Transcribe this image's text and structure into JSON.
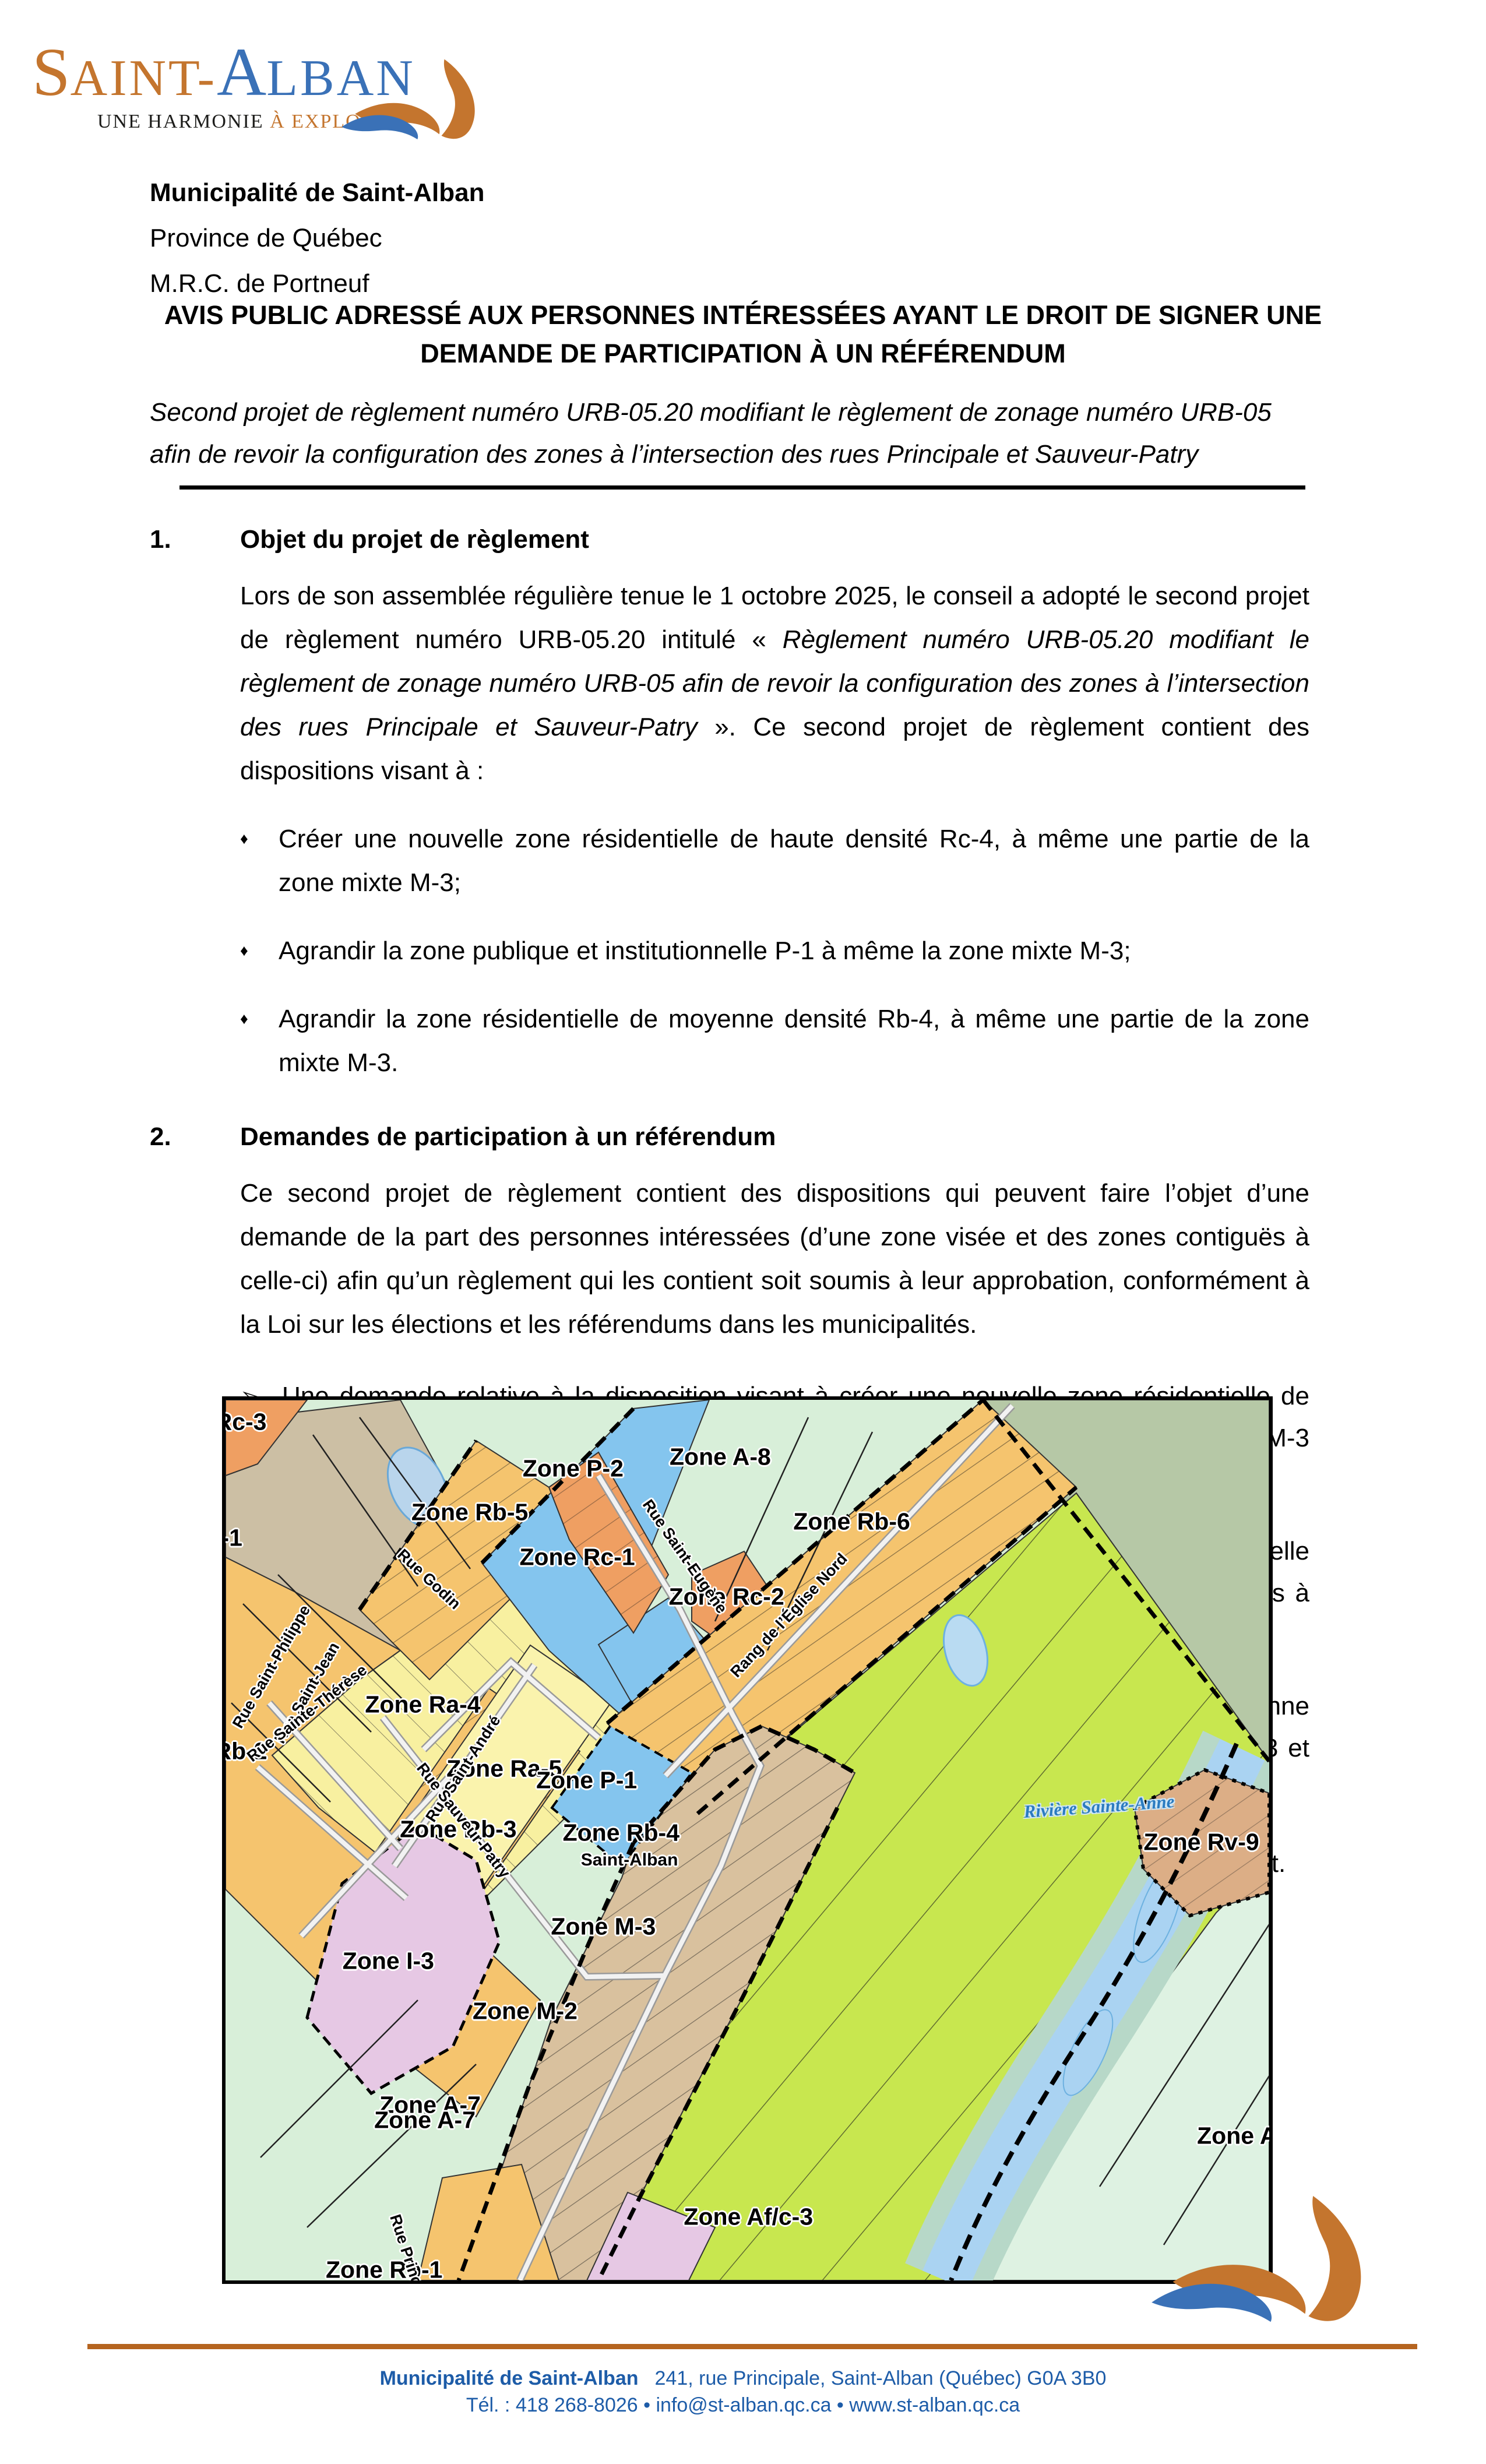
{
  "logo": {
    "orange_initial": "S",
    "orange_rest": "AINT",
    "hyphen": "-",
    "blue_initial": "A",
    "blue_rest": "LBAN",
    "tagline_dark": "UNE HARMONIE ",
    "tagline_orange": "À EXPLORER"
  },
  "header": {
    "line1": "Municipalité de Saint-Alban",
    "line2": "Province de Québec",
    "line3": "M.R.C. de Portneuf"
  },
  "notice": {
    "title": "AVIS PUBLIC ADRESSÉ AUX PERSONNES INTÉRESSÉES AYANT LE DROIT DE SIGNER UNE DEMANDE DE PARTICIPATION À UN RÉFÉRENDUM",
    "subtitle": "Second projet de règlement numéro URB-05.20 modifiant le règlement de zonage numéro URB-05 afin de revoir la configuration des zones à l’intersection des rues Principale et Sauveur-Patry"
  },
  "glyphs": {
    "diamond_bullet": "♦",
    "arrow_bullet": "➢"
  },
  "sections": [
    {
      "num": "1.",
      "title": "Objet du projet de règlement",
      "p_intro": "Lors de son assemblée régulière tenue le 1 octobre 2025, le conseil a adopté le second projet de règlement numéro URB-05.20 intitulé « ",
      "p_italic": "Règlement numéro URB-05.20 modifiant le règlement de zonage numéro URB-05 afin de revoir la configuration des zones à l’intersection des rues Principale et Sauveur-Patry",
      "p_outro": " ». Ce second projet de règlement contient des dispositions visant à :",
      "bullets": [
        "Créer une nouvelle zone résidentielle de haute densité Rc-4, à même une partie de la zone mixte M-3;",
        "Agrandir la zone publique et institutionnelle P-1 à même la zone mixte M-3;",
        "Agrandir la zone résidentielle de moyenne densité Rb-4, à même une partie de la zone mixte M-3."
      ]
    },
    {
      "num": "2.",
      "title": "Demandes de participation à un référendum",
      "paragraph": "Ce second projet de règlement contient des dispositions qui peuvent faire l’objet d’une demande de la part des personnes intéressées (d’une zone visée et des zones contiguës à celle-ci) afin qu’un règlement qui les contient soit soumis à leur approbation, conformément à la Loi sur les élections et les référendums dans les municipalités.",
      "arrow_items": [
        "Une demande relative à la disposition visant à créer une nouvelle zone résidentielle de haute densité Rc-4, à même une partie de la zone mixte M-3 peut provenir de la zone M-3 et des zones contigües à celle-ci, soit Rb-4, P-1, Ra-5, Rb-3, M-2, Af/c-3, P-2 et Rb-5;",
        "Une demande relative à la disposition visant à agrandir la zone publique et institutionnelle P-1 à même la zone mixte M-3 peut provenir de la zone M-3 et des zones contigües à celle-ci, soit Rb-4, P-1, Ra-5, Rb-3, M-2, Af/c-3, P-2 et Rb-5;",
        "Une demande relative à la disposition visant à agrandir la zone résidentielle de moyenne densité Rb-4, à même une partie de la zone mixte M-3 peut provenir de la zone M-3 et des zones contigües à celle-ci, soit soit Rb-4, P-1, Ra-5, Rb-3, M-2, Af/c-3, P-2 et Rb-5;"
      ],
      "closing": "La zone M-3 ainsi que les zones contiguës à celle-ci sont illustrées sur le croquis ci-joint."
    }
  ],
  "map": {
    "labels": [
      {
        "text": "Zone Rc-3",
        "kind": "zone",
        "x": -1.6,
        "y": 2.5,
        "rot": 0
      },
      {
        "text": "-1",
        "kind": "zone",
        "x": 0.6,
        "y": 15.7,
        "rot": 0
      },
      {
        "text": "Zone P-2",
        "kind": "zone",
        "x": 33.3,
        "y": 7.8,
        "rot": 0
      },
      {
        "text": "Zone A-8",
        "kind": "zone",
        "x": 47.4,
        "y": 6.5,
        "rot": 0
      },
      {
        "text": "Zone Rb-5",
        "kind": "zone",
        "x": 23.4,
        "y": 12.8,
        "rot": 0
      },
      {
        "text": "Zone Rc-1",
        "kind": "zone",
        "x": 33.7,
        "y": 17.9,
        "rot": 0
      },
      {
        "text": "Zone Rc-2",
        "kind": "zone",
        "x": 48.0,
        "y": 22.4,
        "rot": 0
      },
      {
        "text": "Zone Rb-6",
        "kind": "zone",
        "x": 60.0,
        "y": 13.8,
        "rot": 0
      },
      {
        "text": "Zone Ra-4",
        "kind": "zone",
        "x": 18.9,
        "y": 34.6,
        "rot": 0
      },
      {
        "text": "Zone Rb-2",
        "kind": "zone",
        "x": -1.6,
        "y": 39.9,
        "rot": 0
      },
      {
        "text": "Zone Ra-5",
        "kind": "zone",
        "x": 26.7,
        "y": 41.9,
        "rot": 0
      },
      {
        "text": "Zone P-1",
        "kind": "zone",
        "x": 34.6,
        "y": 43.2,
        "rot": 0
      },
      {
        "text": "Zone Rb-3",
        "kind": "zone",
        "x": 22.3,
        "y": 48.8,
        "rot": 0
      },
      {
        "text": "Zone Rb-4",
        "kind": "zone",
        "x": 37.9,
        "y": 49.2,
        "rot": 0
      },
      {
        "text": "Saint-Alban",
        "kind": "place",
        "x": 38.7,
        "y": 52.3,
        "rot": 0
      },
      {
        "text": "Zone M-3",
        "kind": "zone",
        "x": 36.2,
        "y": 59.8,
        "rot": 0
      },
      {
        "text": "Zone I-3",
        "kind": "zone",
        "x": 15.6,
        "y": 63.7,
        "rot": 0
      },
      {
        "text": "Zone M-2",
        "kind": "zone",
        "x": 28.7,
        "y": 69.4,
        "rot": 0
      },
      {
        "text": "Zone A-7",
        "kind": "zone",
        "x": 19.6,
        "y": 80.1,
        "rot": 0
      },
      {
        "text": "Zone A-7",
        "kind": "zone",
        "x": 19.1,
        "y": 81.8,
        "rot": 0
      },
      {
        "text": "Zone Af/c-3",
        "kind": "zone",
        "x": 50.1,
        "y": 92.8,
        "rot": 0
      },
      {
        "text": "Zone Rv-9",
        "kind": "zone",
        "x": 93.5,
        "y": 50.2,
        "rot": 0
      },
      {
        "text": "Zone A-",
        "kind": "zone",
        "x": 97.3,
        "y": 83.6,
        "rot": 0
      },
      {
        "text": "Zone Rb-1",
        "kind": "zone",
        "x": 15.2,
        "y": 98.8,
        "rot": 0
      },
      {
        "text": "Rue Saint-Eugène",
        "kind": "street",
        "x": 44.0,
        "y": 17.8,
        "rot": 55
      },
      {
        "text": "Rang de l’Église Nord",
        "kind": "street",
        "x": 54.0,
        "y": 24.5,
        "rot": -47
      },
      {
        "text": "Rue Godin",
        "kind": "street",
        "x": 19.5,
        "y": 20.4,
        "rot": 43
      },
      {
        "text": "Rue Saint-Philippe",
        "kind": "street",
        "x": 4.4,
        "y": 30.3,
        "rot": -60
      },
      {
        "text": "Rue Saint-Jean",
        "kind": "street",
        "x": 7.8,
        "y": 33.3,
        "rot": -60
      },
      {
        "text": "Rue Sainte-Thérèse",
        "kind": "street",
        "x": 7.8,
        "y": 35.6,
        "rot": -38
      },
      {
        "text": "Rue Saint-André",
        "kind": "street",
        "x": 22.8,
        "y": 41.9,
        "rot": -57
      },
      {
        "text": "Rue Sauveur-Patry",
        "kind": "street",
        "x": 22.8,
        "y": 47.8,
        "rot": 52
      },
      {
        "text": "Rue Principale",
        "kind": "street",
        "x": 17.8,
        "y": 98.5,
        "rot": 72
      },
      {
        "text": "Rivière Sainte-Anne",
        "kind": "water",
        "x": 83.7,
        "y": 46.2,
        "rot": -4
      }
    ]
  },
  "footer": {
    "org": "Municipalité de Saint-Alban",
    "address": "241, rue Principale, Saint-Alban (Québec)  G0A 3B0",
    "contact": "Tél. : 418 268-8026 • info@st-alban.qc.ca • www.st-alban.qc.ca"
  },
  "colors": {
    "brand_orange": "#C4752E",
    "brand_blue": "#3A71B7",
    "footer_text": "#1D5CA8",
    "rule_orange": "#B5641F",
    "map_mint": "#D8EFD9",
    "map_gray_green": "#B6C8A6",
    "map_bright_green": "#C8E74F",
    "map_blue_p": "#84C5EE",
    "map_yellow_ra": "#F8F0A0",
    "map_pale_yellow": "#FAF3AD",
    "map_orange_rb": "#F5C46E",
    "map_salmon_rc": "#EF9F62",
    "map_tan_m": "#D9C19E",
    "map_brown": "#CCBFA4",
    "map_purple_i": "#E6C8E4",
    "map_tan_rv": "#DCAE86",
    "map_river_blue": "#AAD3F2",
    "map_river_teal": "#B7D8C8",
    "map_pond": "#B9D5EC"
  }
}
